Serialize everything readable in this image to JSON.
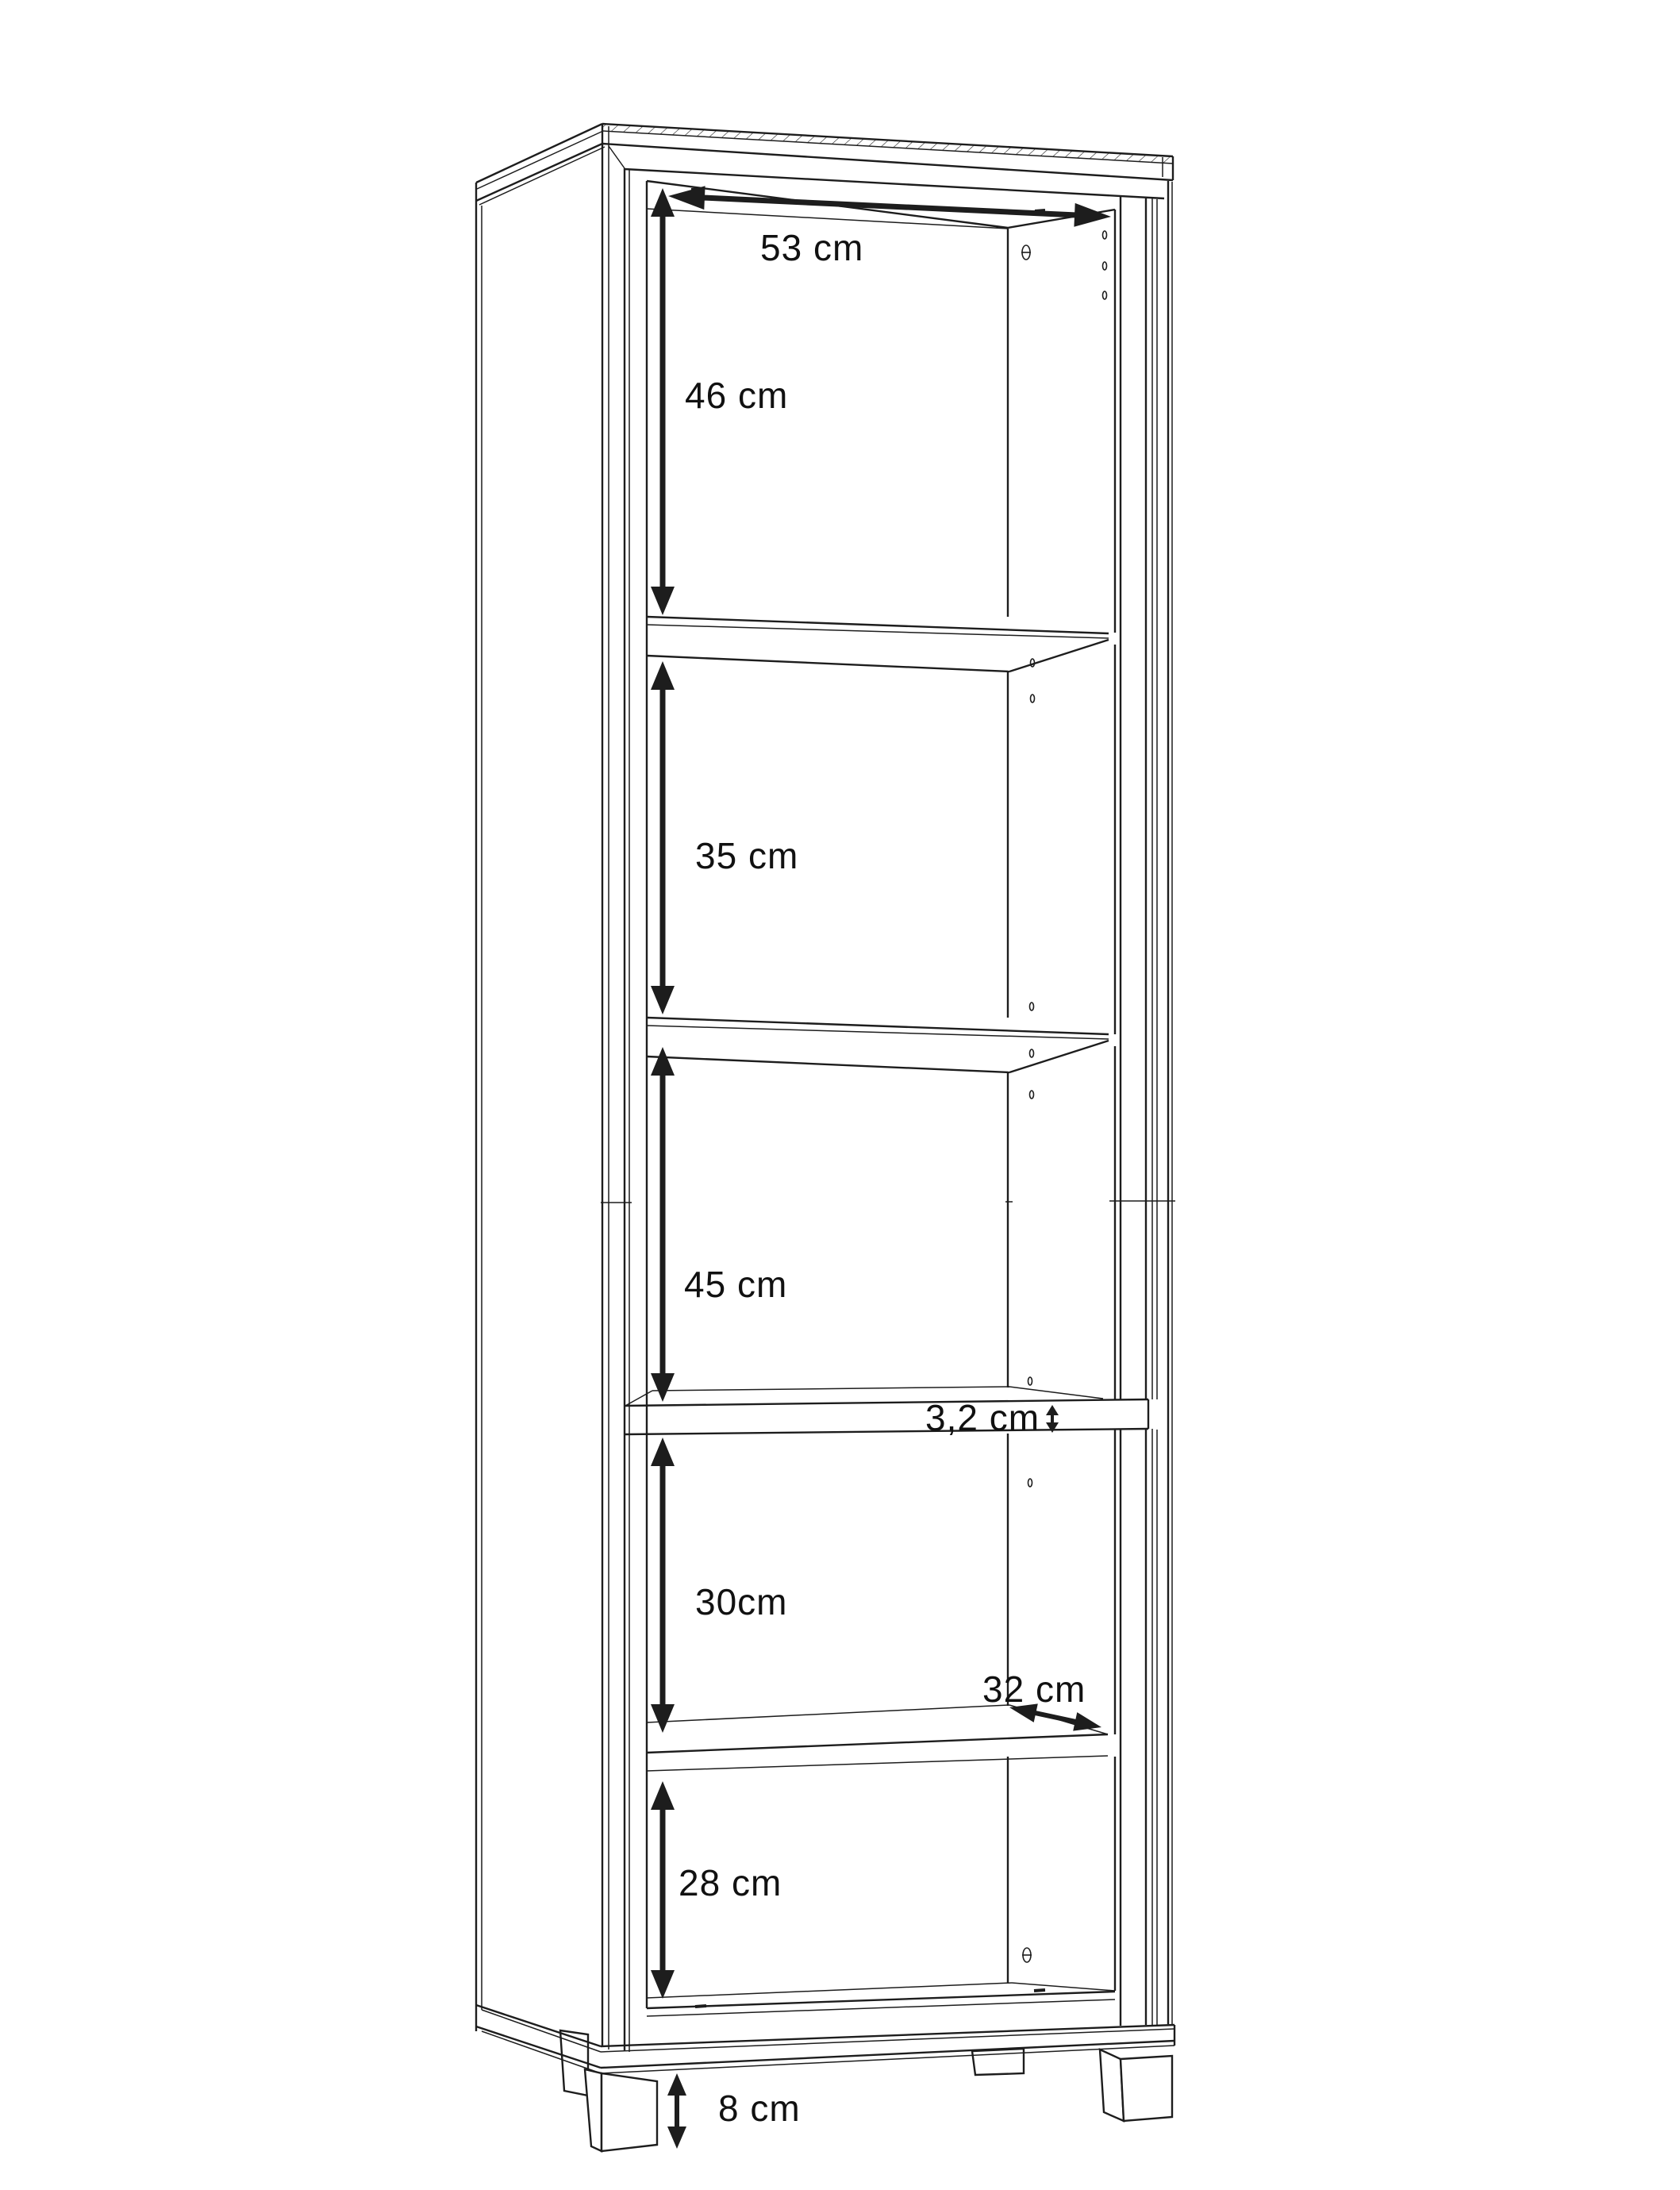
{
  "page": {
    "background": "#ffffff",
    "line_color": "#1d1d1d"
  },
  "dimensions": {
    "interior_width": {
      "label": "53 cm"
    },
    "section_1_height": {
      "label": "46 cm"
    },
    "section_2_height": {
      "label": "35 cm"
    },
    "section_3_height": {
      "label": "45 cm"
    },
    "divider_thickness": {
      "label": "3,2 cm"
    },
    "section_4_height": {
      "label": "30cm"
    },
    "shelf_depth": {
      "label": "32 cm"
    },
    "section_5_height": {
      "label": "28 cm"
    },
    "leg_height": {
      "label": "8 cm"
    }
  }
}
